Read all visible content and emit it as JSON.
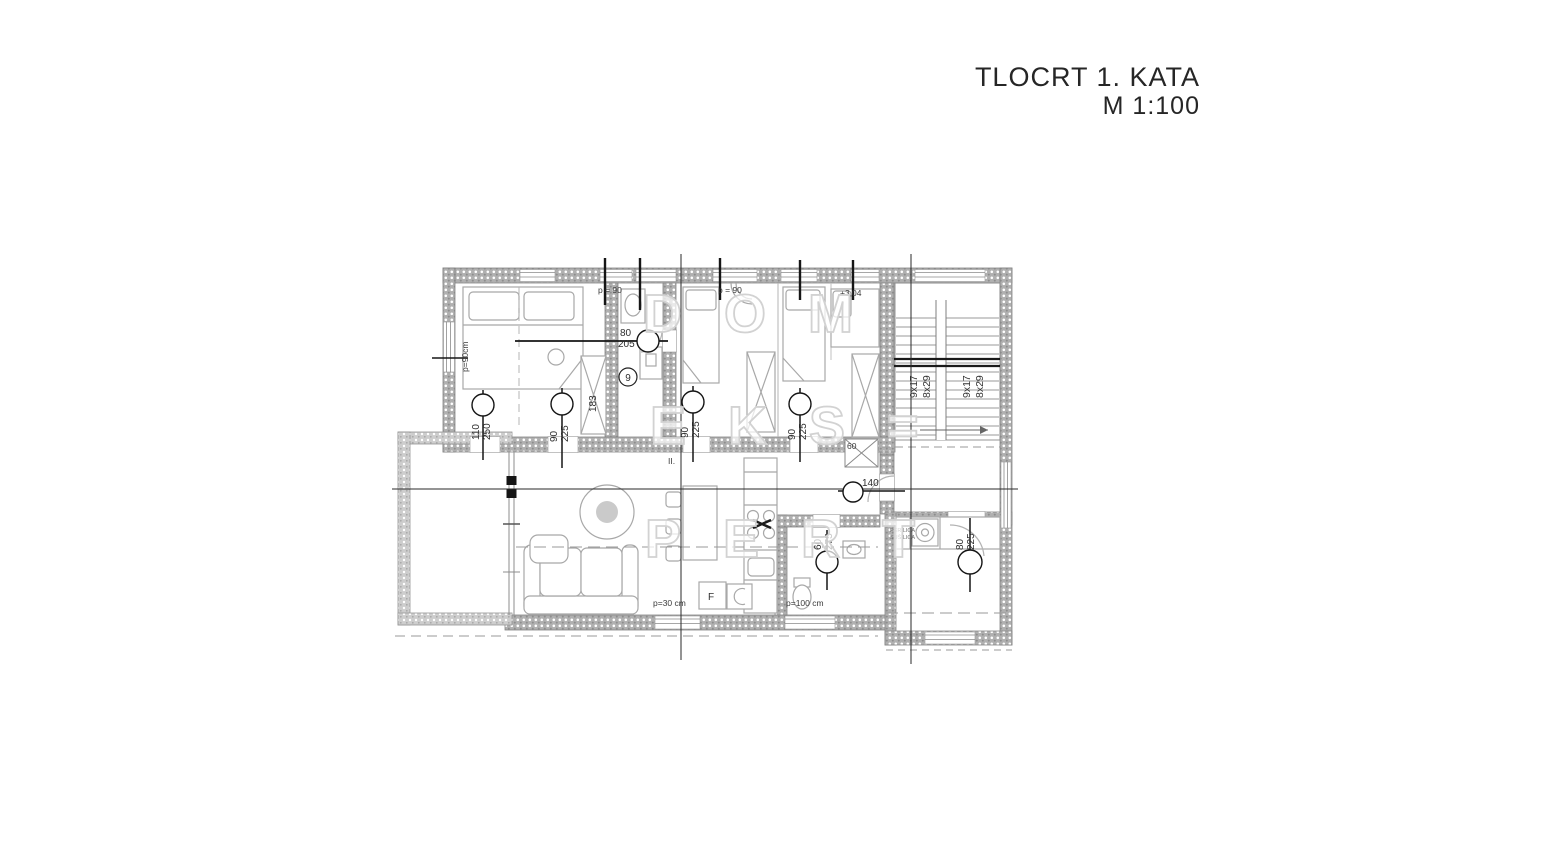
{
  "title": {
    "name": "TLOCRT 1. KATA",
    "scale": "M 1:100"
  },
  "watermark": {
    "line1": "DOM",
    "line2": "EKS=",
    "line3": "PERT"
  },
  "doors": {
    "balcony_bedroom1": {
      "w": "110",
      "h": "250"
    },
    "bedroom1": {
      "w": "90",
      "h": "225"
    },
    "bathroom_top": {
      "w": "80",
      "h": "205"
    },
    "bedroom2": {
      "w": "90",
      "h": "225"
    },
    "bedroom3": {
      "w": "90",
      "h": "225"
    },
    "bathroom": {
      "w": "60",
      "h": "275"
    },
    "laundry": {
      "w": "80",
      "h": "225"
    },
    "corridor_width": "140"
  },
  "stairs": {
    "flight1_steps": "9x17",
    "flight1_rise": "8x29",
    "flight2_steps": "9x17",
    "flight2_rise": "8x29"
  },
  "annotations": {
    "room_number": "9",
    "wardrobe_width": "183",
    "shaft_width": "60",
    "parapet_left": "p=90cm",
    "parapet_top_1": "p = 90",
    "parapet_top_2": "p = 90",
    "level_mark": "+3,04",
    "parapet_living": "p=30 cm",
    "parapet_bathroom": "p=100 cm",
    "hall_mark": "II.",
    "appliance_f": "F",
    "laundry_line1": "PERILICA",
    "laundry_line2": "SUŠILICA"
  },
  "colors": {
    "wall_fill": "#b3b3b3",
    "line": "#8c8c8c",
    "label": "#2e2e2e",
    "section_line": "#1f1f1f",
    "furniture": "#a8a8a8",
    "watermark": "#d2d2d2",
    "title_text": "#262626"
  }
}
